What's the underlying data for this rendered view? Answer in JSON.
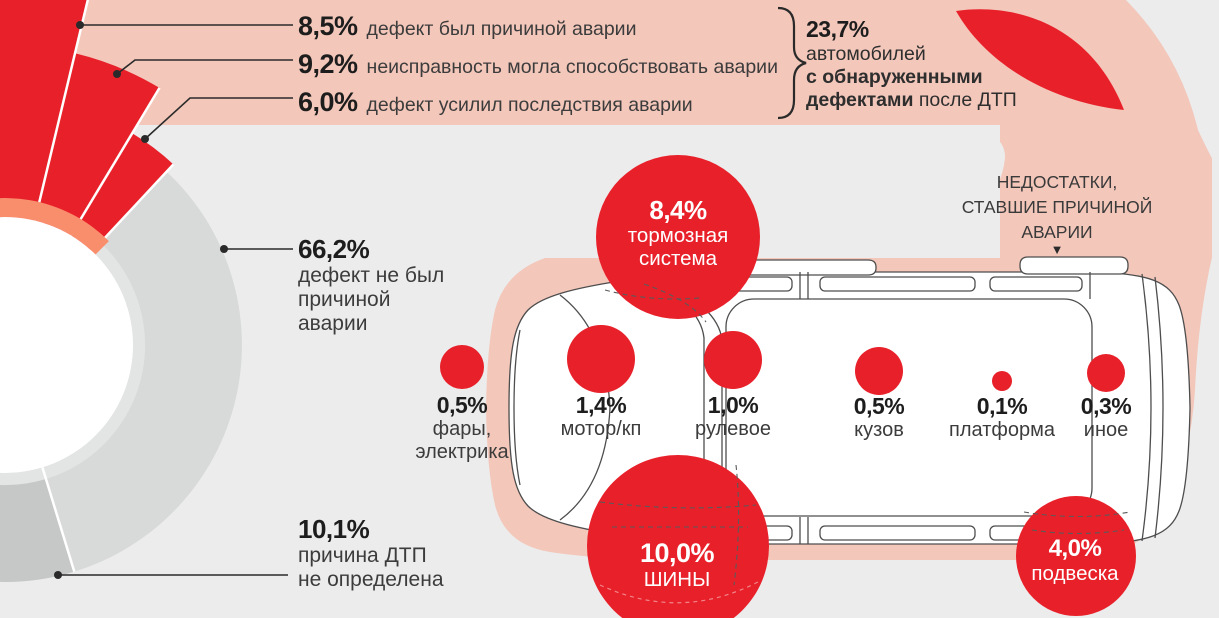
{
  "colors": {
    "background": "#ececec",
    "band_pink": "#f3c7ba",
    "accent_red": "#e8202a",
    "salmon_arc": "#f98e6d",
    "donut_gray": "#d8d9d9",
    "donut_dark_gray": "#c6c7c7",
    "text_dark": "#1d1d1d",
    "text_body": "#3c3c3c",
    "white": "#ffffff"
  },
  "donut_callouts": {
    "cause": {
      "value": "8,5%",
      "label": "дефект был причиной аварии"
    },
    "contrib": {
      "value": "9,2%",
      "label": "неисправность могла способствовать аварии"
    },
    "aggravated": {
      "value": "6,0%",
      "label": "дефект усилил последствия аварии"
    },
    "not_cause": {
      "value": "66,2%",
      "line1": "дефект не был",
      "line2": "причиной",
      "line3": "аварии"
    },
    "undetermined": {
      "value": "10,1%",
      "line1": "причина ДТП",
      "line2": "не определена"
    }
  },
  "summary": {
    "value": "23,7%",
    "line1": "автомобилей",
    "line2": "с обнаруженными",
    "line3_bold": "дефектами",
    "line3_rest": " после ДТП"
  },
  "right_header": {
    "line1": "НЕДОСТАТКИ,",
    "line2": "СТАВШИЕ ПРИЧИНОЙ",
    "line3": "АВАРИИ",
    "arrow": "▼"
  },
  "defects": {
    "brake": {
      "value": "8,4%",
      "line1": "тормозная",
      "line2": "система"
    },
    "lights": {
      "value": "0,5%",
      "line1": "фары,",
      "line2": "электрика"
    },
    "motor": {
      "value": "1,4%",
      "line1": "мотор/кп"
    },
    "steering": {
      "value": "1,0%",
      "line1": "рулевое"
    },
    "body": {
      "value": "0,5%",
      "line1": "кузов"
    },
    "platform": {
      "value": "0,1%",
      "line1": "платформа"
    },
    "other": {
      "value": "0,3%",
      "line1": "иное"
    },
    "tires": {
      "value": "10,0%",
      "line1": "ШИНЫ"
    },
    "suspension": {
      "value": "4,0%",
      "line1": "подвеска"
    }
  },
  "chart_data": [
    {
      "type": "pie",
      "title": "Результаты осмотра автомобилей после ДТП",
      "categories": [
        "дефект был причиной аварии",
        "неисправность могла способствовать аварии",
        "дефект усилил последствия аварии",
        "дефект не был причиной аварии",
        "причина ДТП не определена"
      ],
      "values": [
        8.5,
        9.2,
        6.0,
        66.2,
        10.1
      ],
      "annotation": "23,7% автомобилей с обнаруженными дефектами после ДТП",
      "legend_position": "none",
      "grid": false
    },
    {
      "type": "bar",
      "title": "НЕДОСТАТКИ, СТАВШИЕ ПРИЧИНОЙ АВАРИИ",
      "categories": [
        "тормозная система",
        "шины",
        "подвеска",
        "фары, электрика",
        "мотор/кп",
        "рулевое",
        "кузов",
        "платформа",
        "иное"
      ],
      "values": [
        8.4,
        10.0,
        4.0,
        0.5,
        1.4,
        1.0,
        0.5,
        0.1,
        0.3
      ],
      "xlabel": "",
      "ylabel": "% автомобилей",
      "ylim": [
        0,
        10
      ],
      "grid": false,
      "legend_position": "none"
    }
  ]
}
